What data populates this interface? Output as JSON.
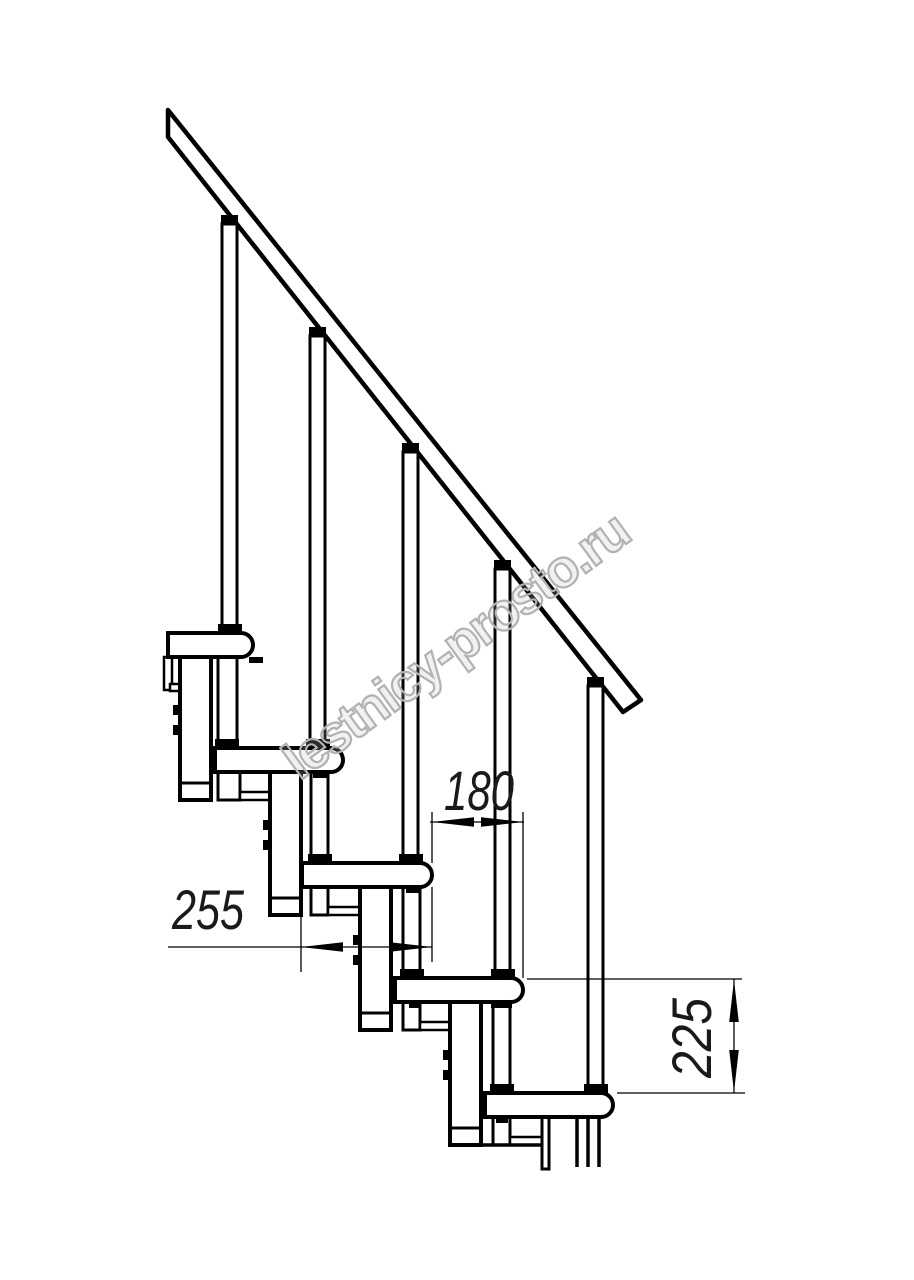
{
  "drawing": {
    "watermark": "lestnicy-prosto.ru",
    "dimensions": {
      "step_run": "180",
      "tread_length": "255",
      "step_rise": "225"
    }
  }
}
